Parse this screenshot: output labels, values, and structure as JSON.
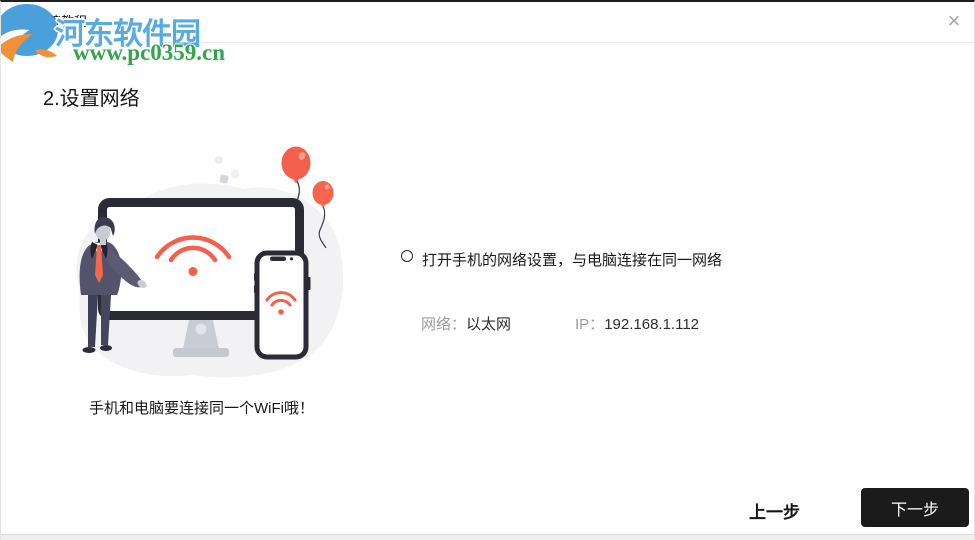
{
  "window": {
    "title": "安卓连接教程",
    "close_glyph": "×"
  },
  "watermark": {
    "site_name": "河东软件园",
    "site_url": "www.pc0359.cn"
  },
  "content": {
    "heading": "2.设置网络",
    "instruction": "打开手机的网络设置，与电脑连接在同一网络",
    "network_label": "网络：",
    "network_value": "以太网",
    "ip_label": "IP：",
    "ip_value": "192.168.1.112",
    "caption": "手机和电脑要连接同一个WiFi哦！"
  },
  "footer": {
    "prev_label": "上一步",
    "next_label": "下一步"
  },
  "colors": {
    "accent_red": "#f4604c",
    "suit_gray": "#53536b",
    "button_dark": "#1b1b1b",
    "label_gray": "#9b9b9b",
    "brand_blue": "#57abdf",
    "brand_green": "#2fa64a",
    "brand_orange": "#f0913a"
  }
}
